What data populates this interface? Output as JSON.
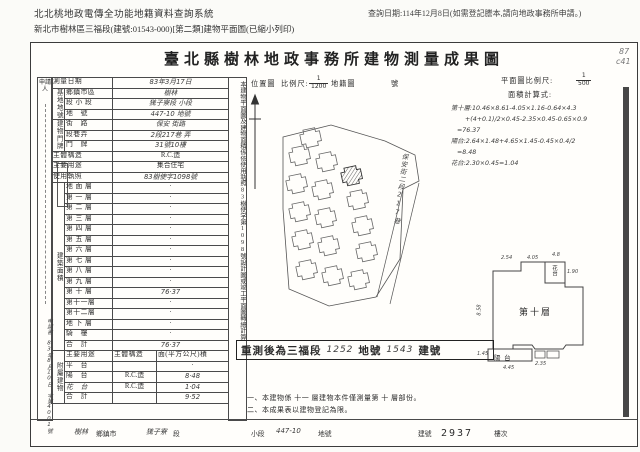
{
  "header": {
    "system_title": "北北桃地政電傳全功能地籍資料查詢系統",
    "query_date": "查詢日期:114年12月8日(如需登記謄本,請向地政事務所申請。)",
    "subtitle": "新北市樹林區三福段(建號:01543-000)[第二類]建物平面圖(已縮小列印)"
  },
  "doc": {
    "title": "臺北縣樹林地政事務所建物測量成果圖",
    "pencil_top": "87",
    "pencil_bottom": "c41",
    "applicant_label": "申請人",
    "application_note": "申請書 83年8月10日 字第4001號",
    "survey": {
      "label": "測量日期",
      "value": "83年3月17日"
    },
    "site_group": "基地地號",
    "site_rows": [
      {
        "label": "鄉鎮市區",
        "value": "樹林"
      },
      {
        "label": "段 小 段",
        "value": "獇子寮段 小段"
      },
      {
        "label": "地　號",
        "value": "447-10 地號"
      }
    ],
    "door_group": "建物門牌",
    "door_rows": [
      {
        "label": "街　路",
        "value": "保安 街路"
      },
      {
        "label": "段巷弄",
        "value": "2段217巷 弄"
      },
      {
        "label": "門　牌",
        "value": "31號10樓"
      }
    ],
    "misc_rows": [
      {
        "label": "主體構造",
        "value": "R.C.造"
      },
      {
        "label": "主要用途",
        "value": "集合住宅"
      },
      {
        "label": "使用執照",
        "value": "83樹使字1098號"
      }
    ],
    "area_group": "建築面積",
    "area_unit": "(平方公尺)",
    "floors": [
      {
        "label": "地 面 層",
        "value": "·"
      },
      {
        "label": "第 一 層",
        "value": "·"
      },
      {
        "label": "第 二 層",
        "value": "·"
      },
      {
        "label": "第 三 層",
        "value": "·"
      },
      {
        "label": "第 四 層",
        "value": "·"
      },
      {
        "label": "第 五 層",
        "value": "·"
      },
      {
        "label": "第 六 層",
        "value": "·"
      },
      {
        "label": "第 七 層",
        "value": "·"
      },
      {
        "label": "第 八 層",
        "value": "·"
      },
      {
        "label": "第 九 層",
        "value": "·"
      },
      {
        "label": "第 十 層",
        "value": "76·37"
      },
      {
        "label": "第十一層",
        "value": "·"
      },
      {
        "label": "第十二層",
        "value": "·"
      },
      {
        "label": "地 下 層",
        "value": "·"
      },
      {
        "label": "騎　樓",
        "value": "·"
      },
      {
        "label": "合　計",
        "value": "76·37"
      }
    ],
    "attach_group": "附屬建物",
    "attach_header": {
      "use": "主要用途",
      "struct": "主體構造",
      "area": "面(平方公尺)積"
    },
    "attach_rows": [
      {
        "label": "平　台",
        "struct": "",
        "value": "·"
      },
      {
        "label": "陽　台",
        "struct": "R.C.造",
        "value": "8·48"
      },
      {
        "label": "花　台",
        "struct": "R.C.造",
        "value": "1·04"
      },
      {
        "label": "合　計",
        "struct": "",
        "value": "9·52"
      }
    ],
    "side_note": "本建物平面圖及建物面積係依使用執照83樹使字第1098號設計圖或竣工平面圖轉繪計算",
    "location": {
      "label": "位置圖",
      "scale_label": "比例尺:",
      "num": "1",
      "den": "1200",
      "map_label": "地籍圖",
      "suffix": "號",
      "street": "保安街二段217巷"
    },
    "plan": {
      "scale_label": "平面圖比例尺:",
      "num": "1",
      "den": "500",
      "calc_label": "面積計算式:",
      "calc_lines": [
        "第十層:10.46×8.61-4.05×1.16-0.64×4.3",
        "+(4+0.1)/2×0.45-2.35×0.45-0.65×0.9",
        "=76.37",
        "陽台:2.64×1.48+4.65×1.45-0.45×0.4/2",
        "=8.48",
        "花台:2.30×0.45=1.04"
      ],
      "floor_label": "第十層",
      "balcony_label": "陽 台",
      "planter_label": "花台",
      "dims": {
        "left": "8.58",
        "top_a": "2.54",
        "top_b": "4.05",
        "top_c": "4.8",
        "right_a": "1.90",
        "balcony": "1.45",
        "bottom_a": "4.45",
        "bottom_b": "2.35"
      }
    },
    "remeasure": {
      "prefix": "重測後為三福段",
      "lot": "1252",
      "lot_suffix": "地號",
      "bldg": "1543",
      "bldg_suffix": "建號"
    },
    "notes": [
      "一、本建物係 十一 層建物本件僅測量第 十 層部份。",
      "二、本成果表以建物登記為限。"
    ],
    "footer": {
      "town": "樹林",
      "town_label": "鄉鎮市",
      "sec": "獇子寮",
      "sec_label": "段",
      "subsec_label": "小段",
      "lot": "447-10",
      "lot_label": "地號",
      "bldg_label": "建號",
      "bldg": "2937",
      "floor_label": "樓次"
    }
  }
}
